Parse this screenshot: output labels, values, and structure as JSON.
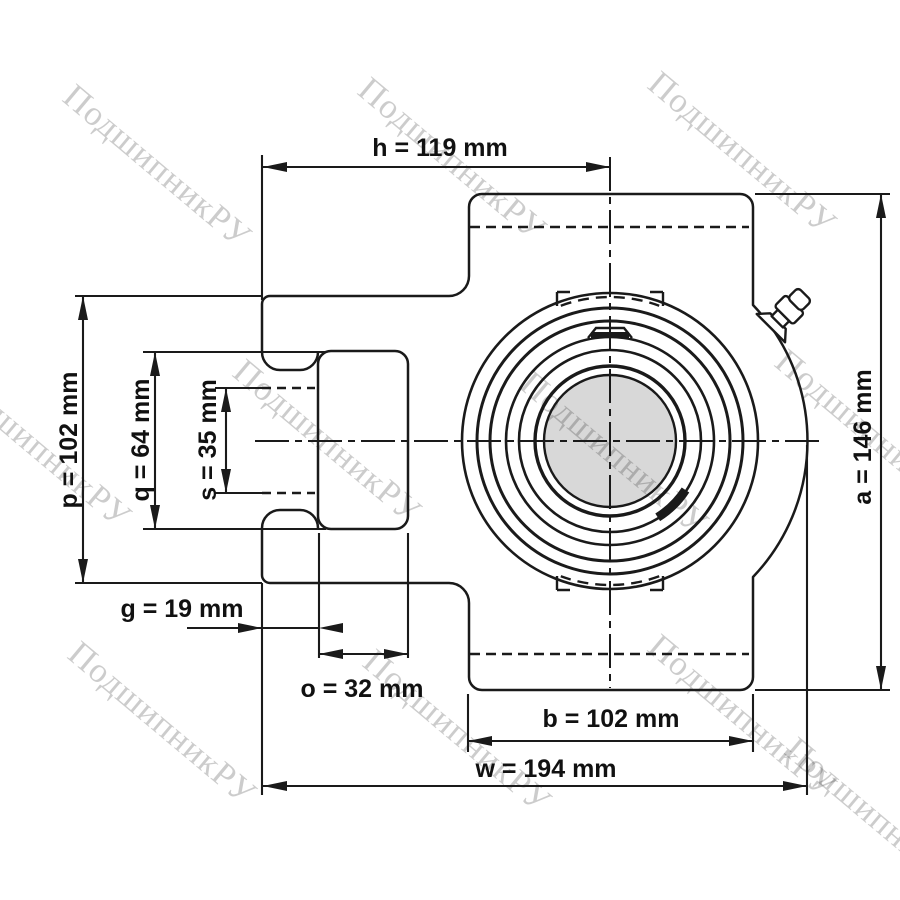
{
  "drawing_title": "take-up bearing unit front view",
  "watermark": {
    "text": "ПодшипникРУ"
  },
  "dimensions": {
    "h": {
      "label": "h = 119 mm"
    },
    "a": {
      "label": "a = 146 mm"
    },
    "p": {
      "label": "p = 102 mm"
    },
    "q": {
      "label": "q = 64 mm"
    },
    "s": {
      "label": "s = 35 mm"
    },
    "g": {
      "label": "g = 19 mm"
    },
    "o": {
      "label": "o = 32 mm"
    },
    "b": {
      "label": "b = 102 mm"
    },
    "w": {
      "label": "w = 194 mm"
    }
  },
  "colors": {
    "line": "#1a1a1a",
    "shaft_fill": "#d8d8d8",
    "watermark": "rgba(0,0,0,0.20)",
    "background": "#ffffff"
  }
}
